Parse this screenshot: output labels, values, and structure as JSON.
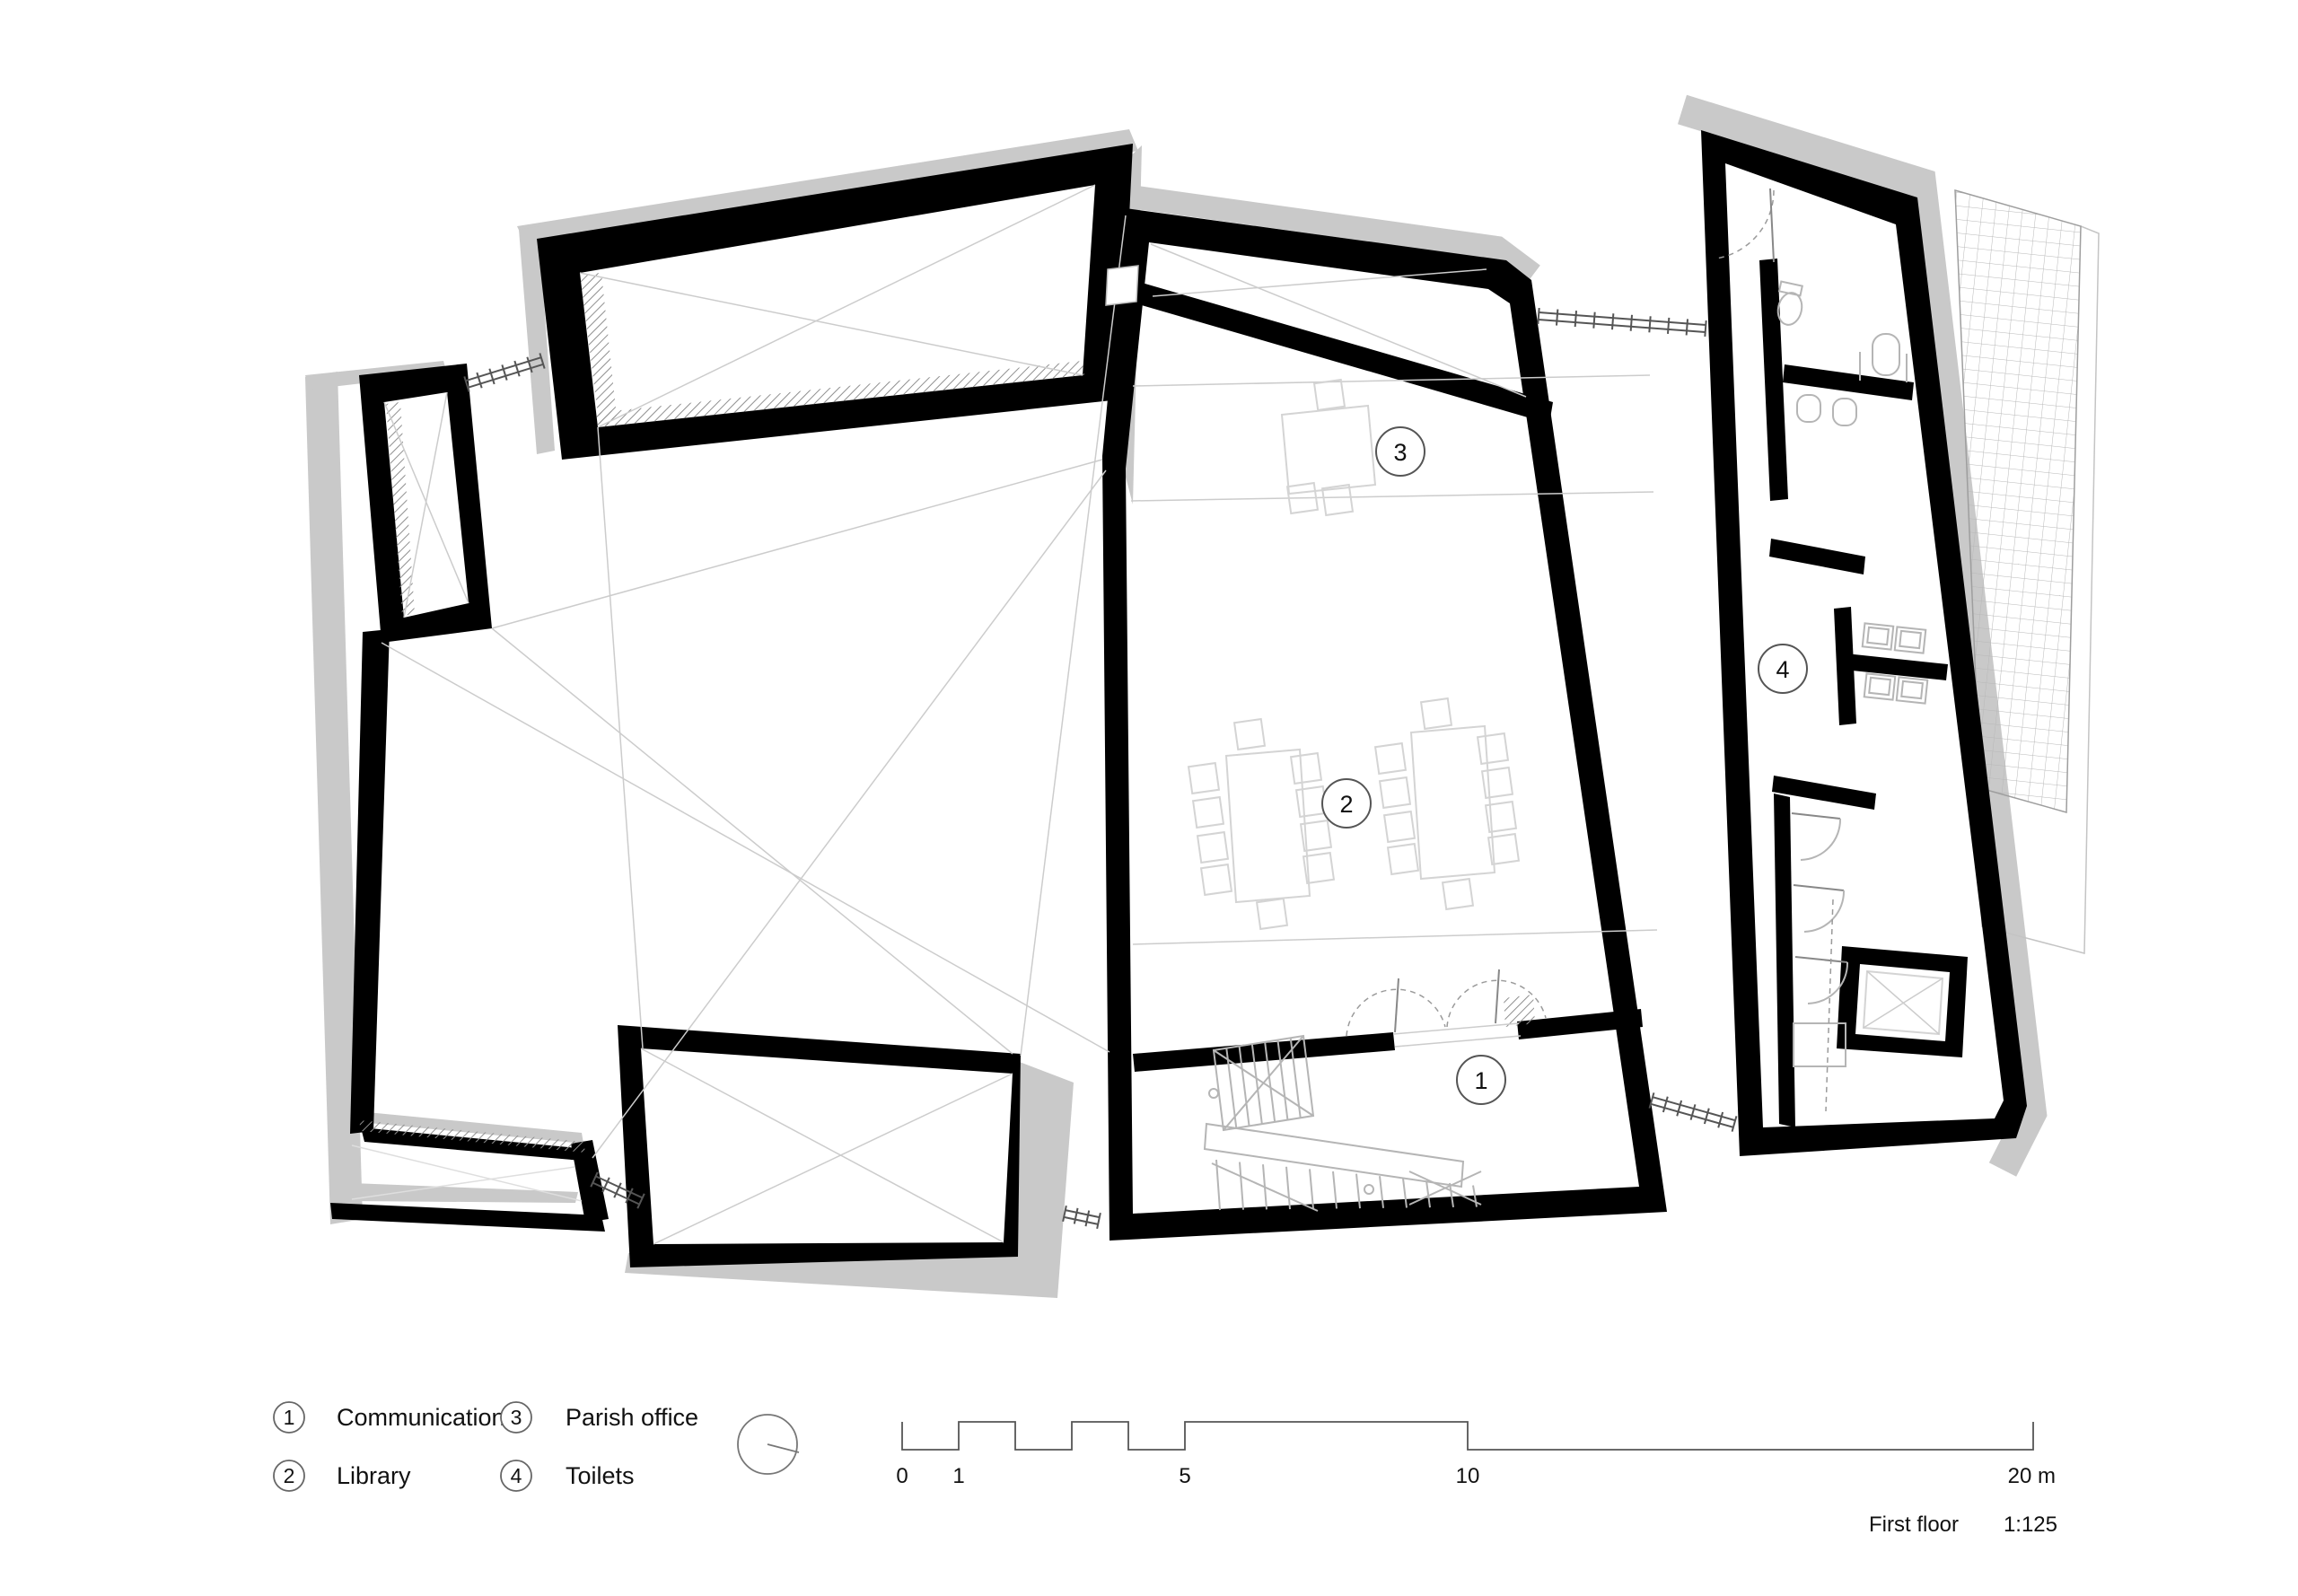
{
  "drawing": {
    "kind": "architectural floor plan",
    "rooms": [
      {
        "number": "1",
        "name": "Communication"
      },
      {
        "number": "2",
        "name": "Library"
      },
      {
        "number": "3",
        "name": "Parish office"
      },
      {
        "number": "4",
        "name": "Toilets"
      }
    ]
  },
  "legend": {
    "items": [
      {
        "number": "1",
        "label": "Communication"
      },
      {
        "number": "2",
        "label": "Library"
      },
      {
        "number": "3",
        "label": "Parish office"
      },
      {
        "number": "4",
        "label": "Toilets"
      }
    ]
  },
  "scale_bar": {
    "tick_labels": [
      "0",
      "1",
      "5",
      "10",
      "20 m"
    ]
  },
  "title_block": {
    "floor_label": "First floor",
    "scale_label": "1:125"
  },
  "colors": {
    "wall": "#000000",
    "poche": "#c9c9c9",
    "hairline": "#cccccc",
    "furniture": "#d4d4d4",
    "stair": "#b5b5b5",
    "fixture": "#b5b5b5",
    "detail": "#555555",
    "text": "#111111",
    "background": "#ffffff"
  }
}
